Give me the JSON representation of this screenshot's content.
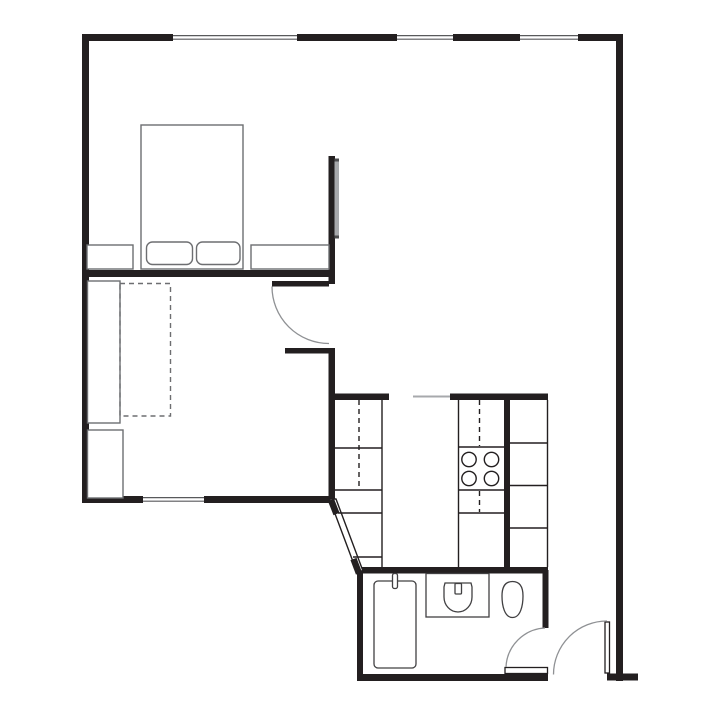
{
  "canvas": {
    "width": 720,
    "height": 720,
    "background": "#ffffff"
  },
  "colors": {
    "wall": "#231f20",
    "furniture": "#6d6e71",
    "fixture": "#414042",
    "arc": "#8f9194",
    "light": "#a7a9ac",
    "window_line": "#58595b",
    "cap": "#4d4d4f"
  },
  "walls": [
    {
      "name": "top-wall-segment-1",
      "x": 82,
      "y": 34,
      "w": 91,
      "h": 7
    },
    {
      "name": "top-wall-segment-2",
      "x": 297,
      "y": 34,
      "w": 100,
      "h": 7
    },
    {
      "name": "top-wall-segment-3",
      "x": 453,
      "y": 34,
      "w": 67,
      "h": 7
    },
    {
      "name": "top-wall-segment-4",
      "x": 578,
      "y": 34,
      "w": 45,
      "h": 7
    },
    {
      "name": "left-exterior-wall",
      "x": 82,
      "y": 34,
      "w": 7,
      "h": 469
    },
    {
      "name": "right-exterior-wall",
      "x": 616,
      "y": 34,
      "w": 7,
      "h": 647
    },
    {
      "name": "bedroom-south-wall",
      "x": 82,
      "y": 270,
      "w": 253,
      "h": 7
    },
    {
      "name": "bedroom-east-wall",
      "x": 328.5,
      "y": 156,
      "w": 6.5,
      "h": 128
    },
    {
      "name": "hall-stub-wall",
      "x": 285,
      "y": 348,
      "w": 50,
      "h": 5.5
    },
    {
      "name": "kitchen-west-wall",
      "x": 328.5,
      "y": 348,
      "w": 6.5,
      "h": 152
    },
    {
      "name": "living-south-wall-1",
      "x": 82,
      "y": 496,
      "w": 61,
      "h": 7
    },
    {
      "name": "living-south-wall-2",
      "x": 204,
      "y": 496,
      "w": 128,
      "h": 7
    },
    {
      "name": "kitchen-cap-left",
      "x": 332,
      "y": 393.5,
      "w": 57,
      "h": 6.5
    },
    {
      "name": "kitchen-cap-right",
      "x": 450,
      "y": 393.5,
      "w": 98,
      "h": 6.5
    },
    {
      "name": "kitchen-mid-wall",
      "x": 504,
      "y": 393.5,
      "w": 6,
      "h": 177
    },
    {
      "name": "bathroom-north-wall",
      "x": 357,
      "y": 567,
      "w": 191,
      "h": 6.5
    },
    {
      "name": "bathroom-west-wall",
      "x": 357,
      "y": 570,
      "w": 6,
      "h": 111
    },
    {
      "name": "bathroom-east-wall",
      "x": 542.5,
      "y": 570,
      "w": 6,
      "h": 58
    },
    {
      "name": "bathroom-south-wall",
      "x": 357,
      "y": 674,
      "w": 191,
      "h": 7
    },
    {
      "name": "entry-threshold-foot",
      "x": 607,
      "y": 673.5,
      "w": 31,
      "h": 7
    }
  ],
  "windows": [
    {
      "name": "bedroom-window",
      "x": 173,
      "y": 34,
      "w": 124,
      "h": 7
    },
    {
      "name": "dining-window-left",
      "x": 397,
      "y": 34,
      "w": 56,
      "h": 7
    },
    {
      "name": "dining-window-right",
      "x": 520,
      "y": 34,
      "w": 58,
      "h": 7
    },
    {
      "name": "living-room-window",
      "x": 143,
      "y": 496,
      "w": 61,
      "h": 7
    }
  ],
  "diagonal_wall": {
    "name": "angled-hall-wall",
    "polygon": "329.5,499 336,499 363,571 356.5,571",
    "caps": [
      {
        "x1": 331,
        "y1": 500,
        "x2": 336.5,
        "y2": 514
      },
      {
        "x1": 353.5,
        "y1": 559,
        "x2": 359,
        "y2": 573.5
      }
    ]
  },
  "door_leaves": [
    {
      "name": "living-room-door-leaf",
      "x": 272,
      "y": 281,
      "w": 57,
      "h": 5.5,
      "style": "solid"
    },
    {
      "name": "bathroom-door-leaf",
      "x": 505,
      "y": 667.5,
      "w": 42.5,
      "h": 6,
      "style": "outline"
    },
    {
      "name": "entry-door-leaf",
      "x": 605,
      "y": 622,
      "w": 4.5,
      "h": 51,
      "style": "outline"
    }
  ],
  "door_arcs": [
    {
      "name": "living-room-door-swing-arc",
      "d": "M272,286.5 A57,57 0 0 0 329,343.5"
    },
    {
      "name": "bathroom-door-swing-arc",
      "d": "M506,667 A41,41 0 0 1 545,628"
    },
    {
      "name": "entry-door-swing-arc",
      "d": "M607,621 A53.5,53.5 0 0 0 553.5,674.5"
    }
  ],
  "furniture": [
    {
      "name": "double-bed",
      "x": 141,
      "y": 125,
      "w": 102,
      "h": 144,
      "rx": 0,
      "style": "solid"
    },
    {
      "name": "bed-pillow-left",
      "x": 146.5,
      "y": 242,
      "w": 46,
      "h": 22.5,
      "rx": 6,
      "style": "solid"
    },
    {
      "name": "bed-pillow-right",
      "x": 196.5,
      "y": 242,
      "w": 43.5,
      "h": 22.5,
      "rx": 6,
      "style": "solid"
    },
    {
      "name": "nightstand-left",
      "x": 87,
      "y": 245,
      "w": 46,
      "h": 24,
      "rx": 0,
      "style": "solid"
    },
    {
      "name": "nightstand-right",
      "x": 251,
      "y": 245,
      "w": 78,
      "h": 24,
      "rx": 0,
      "style": "solid"
    },
    {
      "name": "sofa",
      "x": 87.5,
      "y": 281,
      "w": 32.5,
      "h": 142,
      "rx": 0,
      "style": "solid"
    },
    {
      "name": "sofa-bed-fold-out",
      "x": 120,
      "y": 283.5,
      "w": 50.5,
      "h": 132.5,
      "rx": 0,
      "style": "dashed"
    },
    {
      "name": "storage-cabinet",
      "x": 87.5,
      "y": 430,
      "w": 35.5,
      "h": 68,
      "rx": 0,
      "style": "solid"
    }
  ],
  "sliding_panel": {
    "name": "bedroom-sliding-panel",
    "x": 334.5,
    "y": 158.5,
    "w": 4.5,
    "h": 80,
    "cap_h": 3
  },
  "kitchen_lines": [
    {
      "name": "left-counter-front-edge",
      "x1": 382,
      "y1": 400,
      "x2": 382,
      "y2": 567.5,
      "dashed": false
    },
    {
      "name": "left-counter-division-1",
      "x1": 335,
      "y1": 448,
      "x2": 382,
      "y2": 448,
      "dashed": false
    },
    {
      "name": "left-counter-division-2",
      "x1": 335,
      "y1": 490,
      "x2": 382,
      "y2": 490,
      "dashed": false
    },
    {
      "name": "left-counter-division-3",
      "x1": 338,
      "y1": 513,
      "x2": 382,
      "y2": 513,
      "dashed": false
    },
    {
      "name": "left-counter-division-4",
      "x1": 353,
      "y1": 557,
      "x2": 382,
      "y2": 557,
      "dashed": false
    },
    {
      "name": "left-counter-appliance",
      "x1": 359,
      "y1": 400,
      "x2": 359,
      "y2": 489,
      "dashed": true
    },
    {
      "name": "stove-counter-left-edge",
      "x1": 458.5,
      "y1": 400,
      "x2": 458.5,
      "y2": 567,
      "dashed": false
    },
    {
      "name": "stove-top-line",
      "x1": 458.5,
      "y1": 447,
      "x2": 504,
      "y2": 447,
      "dashed": false
    },
    {
      "name": "stove-bottom-line",
      "x1": 458.5,
      "y1": 490,
      "x2": 504,
      "y2": 490,
      "dashed": false
    },
    {
      "name": "stove-counter-division",
      "x1": 458.5,
      "y1": 513,
      "x2": 504,
      "y2": 513,
      "dashed": false
    },
    {
      "name": "stove-counter-appliance-1",
      "x1": 479.5,
      "y1": 400,
      "x2": 479.5,
      "y2": 446,
      "dashed": true
    },
    {
      "name": "stove-counter-appliance-2",
      "x1": 479.5,
      "y1": 491,
      "x2": 479.5,
      "y2": 512,
      "dashed": true
    },
    {
      "name": "right-counter-front-edge",
      "x1": 547.5,
      "y1": 400,
      "x2": 547.5,
      "y2": 567,
      "dashed": false
    },
    {
      "name": "right-counter-division-1",
      "x1": 510,
      "y1": 443,
      "x2": 547.5,
      "y2": 443,
      "dashed": false
    },
    {
      "name": "right-counter-division-2",
      "x1": 510,
      "y1": 485.5,
      "x2": 547.5,
      "y2": 485.5,
      "dashed": false
    },
    {
      "name": "right-counter-division-3",
      "x1": 510,
      "y1": 528,
      "x2": 547.5,
      "y2": 528,
      "dashed": false
    }
  ],
  "pass_line": {
    "name": "kitchen-pass-line",
    "x1": 413,
    "y1": 396.5,
    "x2": 450,
    "y2": 396.5
  },
  "stove_burners": [
    {
      "cx": 469,
      "cy": 459.5,
      "r": 7.2
    },
    {
      "cx": 491.5,
      "cy": 459.5,
      "r": 7.2
    },
    {
      "cx": 469,
      "cy": 478.5,
      "r": 7.2
    },
    {
      "cx": 491.5,
      "cy": 478.5,
      "r": 7.2
    }
  ],
  "fixtures": [
    {
      "name": "shower-tray",
      "kind": "rect",
      "x": 374,
      "y": 581,
      "w": 42,
      "h": 87,
      "rx": 4
    },
    {
      "name": "shower-faucet",
      "kind": "rect",
      "x": 392.5,
      "y": 573.5,
      "w": 5,
      "h": 15,
      "rx": 2
    },
    {
      "name": "sink-counter",
      "kind": "rect",
      "x": 426,
      "y": 573.5,
      "w": 63,
      "h": 43.5,
      "rx": 0
    },
    {
      "name": "sink-basin",
      "kind": "path",
      "d": "M445,583 L471,583 L472,587 L472,597 A14,15 0 0 1 444,597 L444,587 Z"
    },
    {
      "name": "sink-faucet",
      "kind": "rect",
      "x": 455,
      "y": 583.5,
      "w": 6.5,
      "h": 10.5,
      "rx": 1
    },
    {
      "name": "toilet",
      "kind": "path",
      "d": "M502,596 C502,586 505.5,581.5 512.5,581.5 C519.5,581.5 523,586 523,596 C523,605.5 520.5,617.5 512.5,617.5 C504.5,617.5 502,605.5 502,596 Z"
    }
  ]
}
